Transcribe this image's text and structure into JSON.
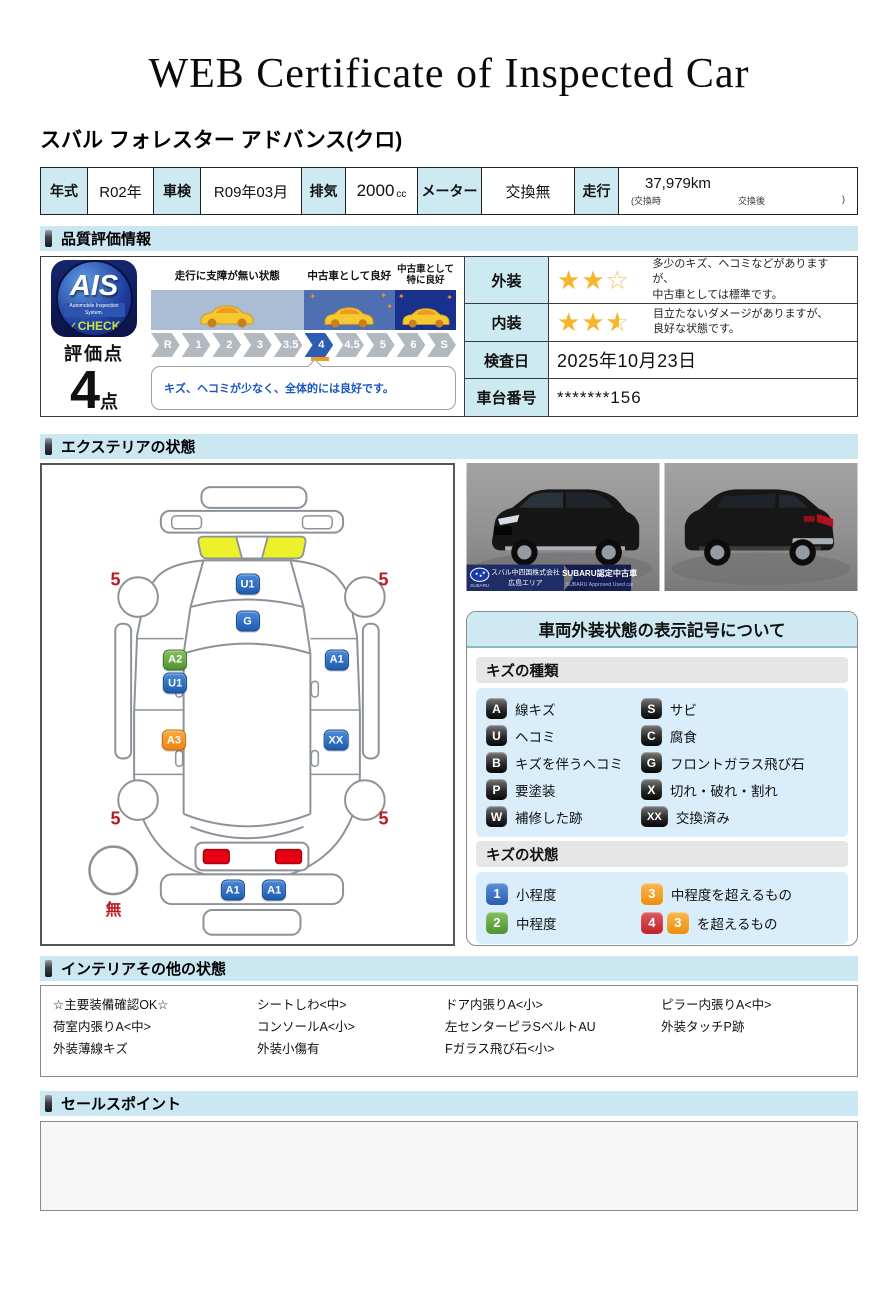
{
  "header": {
    "title": "WEB Certificate of Inspected Car",
    "car_name": "スバル フォレスター アドバンス(クロ)"
  },
  "spec": {
    "year_label": "年式",
    "year_value": "R02年",
    "inspection_label": "車検",
    "inspection_value": "R09年03月",
    "displacement_label": "排気",
    "displacement_value": "2000",
    "displacement_unit": "cc",
    "meter_label": "メーター",
    "meter_value": "交換無",
    "mileage_label": "走行",
    "mileage_value": "37,979km",
    "mileage_note_open": "(交換時",
    "mileage_note_mid": "交換後",
    "mileage_note_close": ")"
  },
  "quality": {
    "section_title": "品質評価情報",
    "ais_logo": {
      "text": "AIS",
      "subtext": "Automobile Inspection System.",
      "check_mark": "✓",
      "check_text": "CHECK"
    },
    "score_label": "評価点",
    "score_value": "4",
    "score_unit": "点",
    "zones": [
      {
        "label": "走行に支障が無い状態"
      },
      {
        "label": "中古車として良好"
      },
      {
        "label": "中古車として特に良好"
      }
    ],
    "steps": [
      "R",
      "1",
      "2",
      "3",
      "3.5",
      "4",
      "4.5",
      "5",
      "6",
      "S"
    ],
    "active_step": "4",
    "comment": "キズ、ヘコミが少なく、全体的には良好です。",
    "details": [
      {
        "label": "外装",
        "stars": 2,
        "stars_total": 3,
        "text1": "多少のキズ、ヘコミなどがありますが、",
        "text2": "中古車としては標準です。"
      },
      {
        "label": "内装",
        "stars": 2.5,
        "stars_total": 3,
        "text1": "目立たないダメージがありますが、",
        "text2": "良好な状態です。"
      },
      {
        "label": "検査日",
        "value": "2025年10月23日"
      },
      {
        "label": "車台番号",
        "value": "*******156"
      }
    ]
  },
  "exterior": {
    "section_title": "エクステリアの状態",
    "markers": [
      {
        "code": "U1",
        "color": "blue",
        "x_pct": 50.0,
        "y_pct": 24.9
      },
      {
        "code": "G",
        "color": "blue",
        "x_pct": 50.0,
        "y_pct": 32.6
      },
      {
        "code": "A2",
        "color": "green",
        "x_pct": 32.4,
        "y_pct": 40.7
      },
      {
        "code": "U1",
        "color": "blue",
        "x_pct": 32.4,
        "y_pct": 45.6
      },
      {
        "code": "A1",
        "color": "blue",
        "x_pct": 71.7,
        "y_pct": 40.7
      },
      {
        "code": "A3",
        "color": "orange",
        "x_pct": 32.1,
        "y_pct": 57.5
      },
      {
        "code": "XX",
        "color": "blue",
        "x_pct": 71.5,
        "y_pct": 57.5
      },
      {
        "code": "A1",
        "color": "blue",
        "x_pct": 46.4,
        "y_pct": 88.8
      },
      {
        "code": "A1",
        "color": "blue",
        "x_pct": 56.5,
        "y_pct": 88.8
      }
    ],
    "wheel_scores": [
      {
        "value": "5",
        "x_pct": 17.9,
        "y_pct": 24.1
      },
      {
        "value": "5",
        "x_pct": 83.1,
        "y_pct": 24.1
      },
      {
        "value": "5",
        "x_pct": 17.9,
        "y_pct": 73.9
      },
      {
        "value": "5",
        "x_pct": 83.1,
        "y_pct": 73.9
      }
    ],
    "spare_label": {
      "value": "無",
      "x_pct": 17.4,
      "y_pct": 92.5
    }
  },
  "photos": {
    "dealer_line1": "スバル中四国株式会社",
    "dealer_line2": "広島エリア",
    "brand": "SUBARU",
    "badge_title": "SUBARU認定中古車",
    "badge_sub": "SUBARU Approved Used car"
  },
  "legend": {
    "title": "車両外装状態の表示記号について",
    "kind_header": "キズの種類",
    "kinds": [
      {
        "code": "A",
        "label": "線キズ"
      },
      {
        "code": "S",
        "label": "サビ"
      },
      {
        "code": "U",
        "label": "ヘコミ"
      },
      {
        "code": "C",
        "label": "腐食"
      },
      {
        "code": "B",
        "label": "キズを伴うヘコミ"
      },
      {
        "code": "G",
        "label": "フロントガラス飛び石"
      },
      {
        "code": "P",
        "label": "要塗装"
      },
      {
        "code": "X",
        "label": "切れ・破れ・割れ"
      },
      {
        "code": "W",
        "label": "補修した跡"
      },
      {
        "code": "XX",
        "label": "交換済み"
      }
    ],
    "state_header": "キズの状態",
    "states": [
      {
        "code": "1",
        "color": "blue",
        "label": "小程度"
      },
      {
        "code": "3",
        "color": "orange",
        "label": "中程度を超えるもの"
      },
      {
        "code": "2",
        "color": "green",
        "label": "中程度"
      },
      {
        "code": "4",
        "color": "red",
        "extra_code": "3",
        "extra_color": "orange",
        "label": "を超えるもの"
      }
    ]
  },
  "interior": {
    "section_title": "インテリアその他の状態",
    "columns": [
      [
        "☆主要装備確認OK☆",
        "荷室内張りA<中>",
        "外装薄線キズ"
      ],
      [
        "シートしわ<中>",
        "コンソールA<小>",
        "外装小傷有"
      ],
      [
        "ドア内張りA<小>",
        "左センターピラSベルトAU",
        "Fガラス飛び石<小>"
      ],
      [
        "ピラー内張りA<中>",
        "外装タッチP跡"
      ]
    ]
  },
  "sales": {
    "section_title": "セールスポイント",
    "content": ""
  },
  "colors": {
    "section_header_bg": "#cbe7f2",
    "table_header_bg": "#cde9f2",
    "zone1_band": "#a9bcd4",
    "zone2_band": "#4e70b2",
    "zone3_band": "#17318c",
    "active_step": "#2c5db0",
    "active_marker": "#f39a1e",
    "star": "#f6b52a",
    "comment_text": "#1a56c4",
    "score_red": "#c11920",
    "taillight_red": "#e60015",
    "replaced_panel": "#c9eef8"
  }
}
